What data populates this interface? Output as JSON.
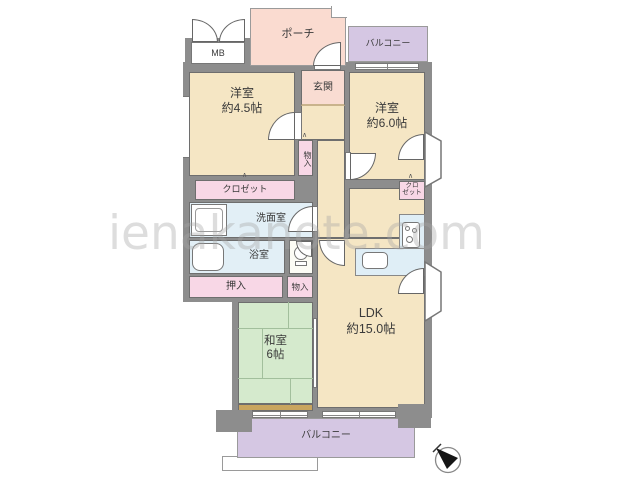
{
  "title": "マンション間取り図 (apartment floor plan)",
  "watermark": {
    "text": "ienakanote.com"
  },
  "rooms": {
    "western1": {
      "name": "洋室",
      "size": "約4.5帖"
    },
    "western2": {
      "name": "洋室",
      "size": "約6.0帖"
    },
    "japanese": {
      "name": "和室",
      "size": "6帖"
    },
    "ldk": {
      "name": "LDK",
      "size": "約15.0帖"
    },
    "entrance": {
      "label": "玄関"
    },
    "washroom": {
      "label": "洗面室"
    },
    "bathroom": {
      "label": "浴室"
    }
  },
  "storage": {
    "closet_west1": {
      "label": "クロゼット"
    },
    "closet_west2": {
      "line1": "クロ",
      "line2": "ゼット"
    },
    "hall_storage": {
      "label": "物入"
    },
    "oshiire": {
      "label": "押入"
    },
    "storage2": {
      "label": "物入"
    }
  },
  "outdoor": {
    "porch": {
      "label": "ポーチ"
    },
    "balcony_top": {
      "label": "バルコニー"
    },
    "balcony_bottom": {
      "label": "バルコニー"
    }
  },
  "utility": {
    "meter_box": {
      "label": "MB"
    }
  },
  "icons": [
    "compass-icon",
    "bathtub-icon",
    "toilet-icon",
    "stove-icon",
    "sink-icon",
    "washing-machine-icon"
  ],
  "colors": {
    "wall": "#8d8d8d",
    "room_floor": "#f5e6c4",
    "tatami_green": "#d5eacd",
    "wet_area_blue": "#e2eff6",
    "storage_pink": "#f8d7e6",
    "porch_pink": "#fadbd0",
    "balcony_purple": "#d5c7e3",
    "tatami_edge_tan": "#c9a55f"
  }
}
